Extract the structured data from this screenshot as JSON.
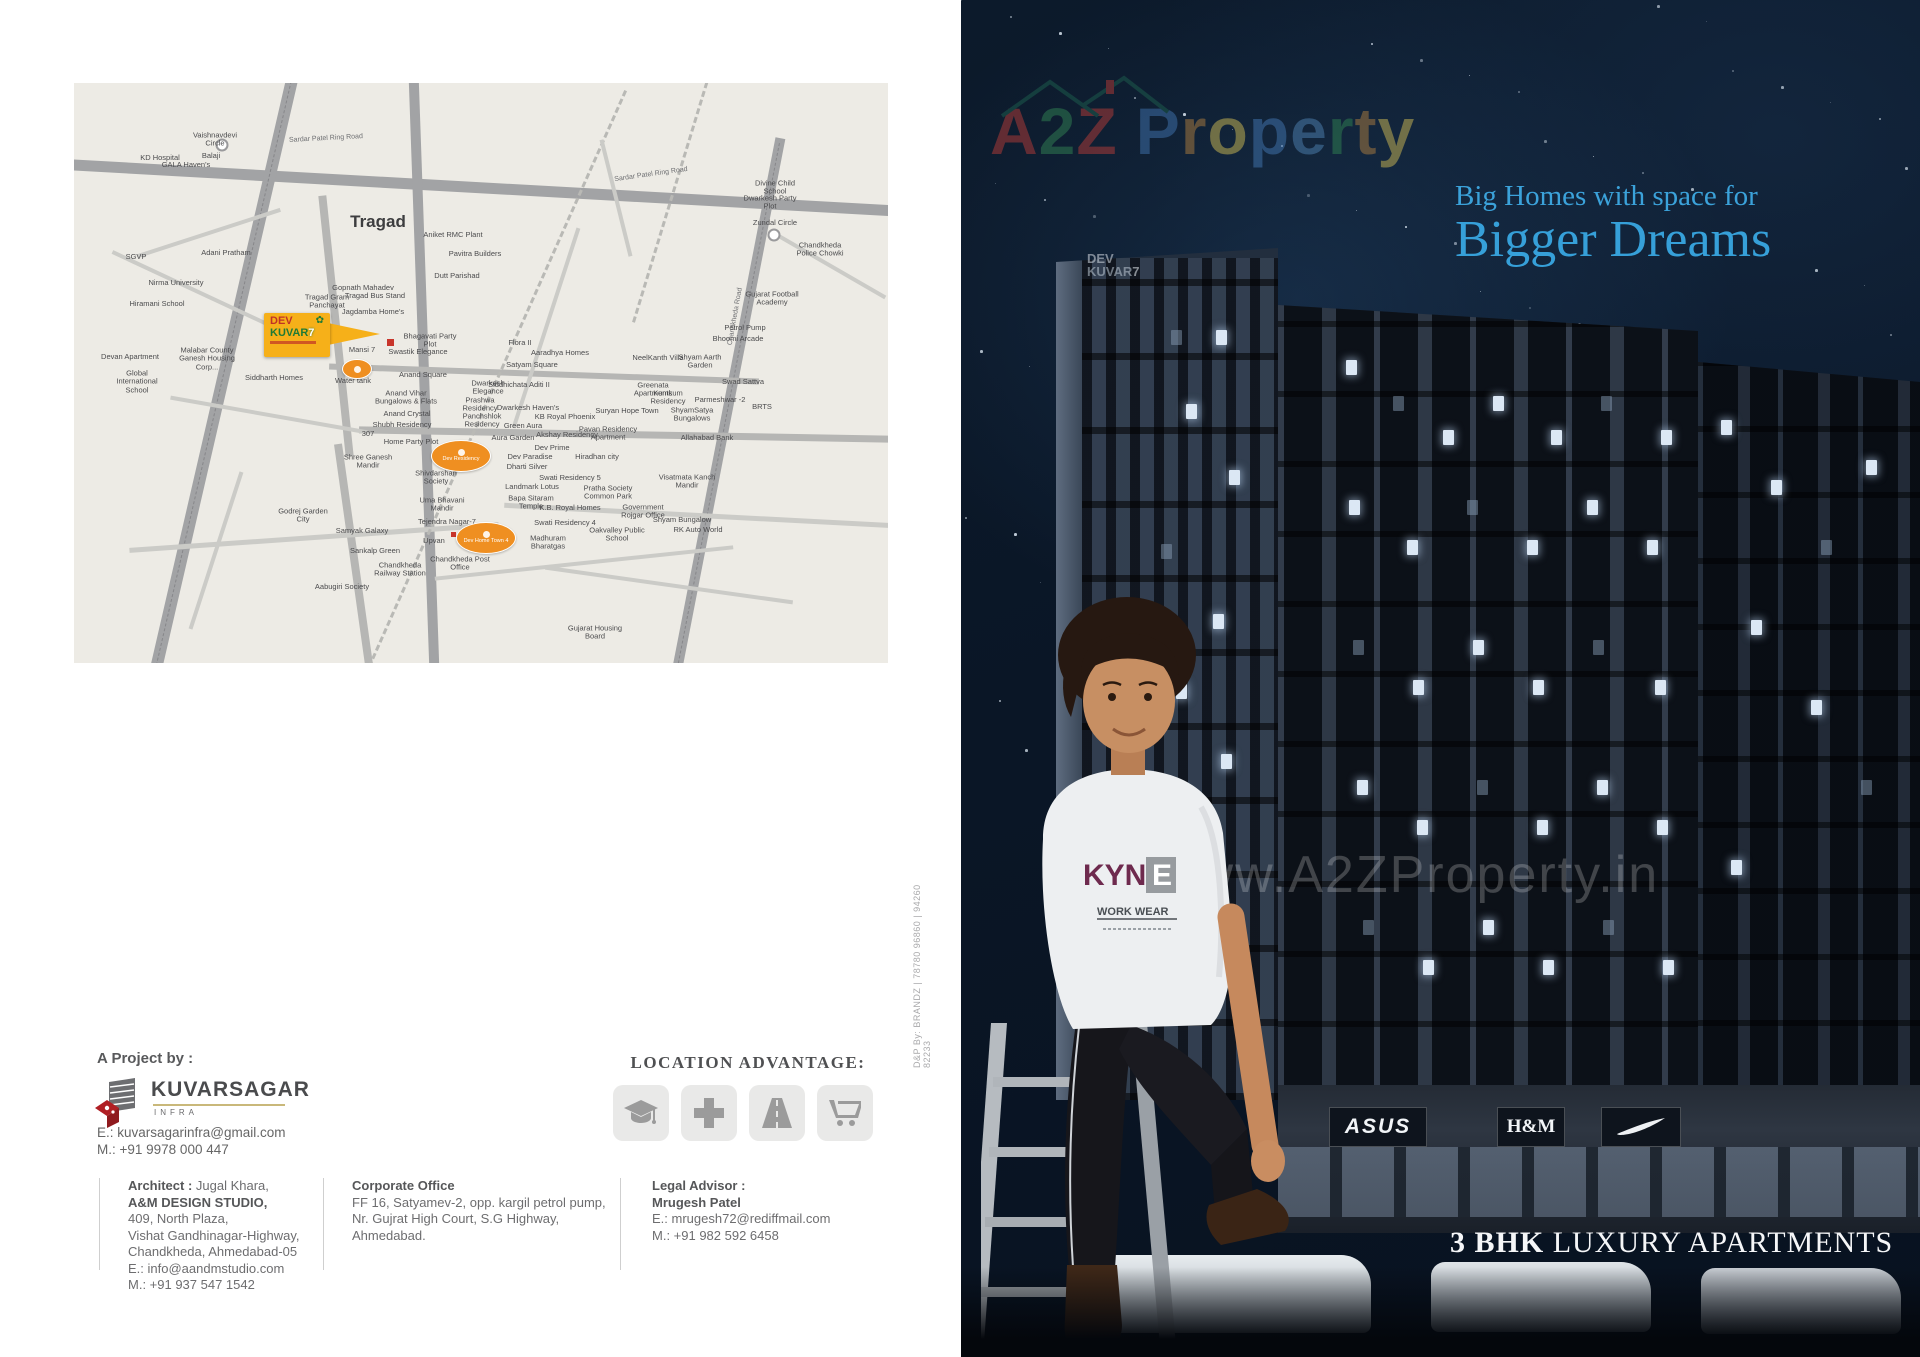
{
  "brochure": {
    "left": {
      "map": {
        "area_label": "Tragad",
        "ring_road_label": "Sardar Patel Ring Road",
        "chandkheda_road_label": "Chandkheda Road",
        "project_box": {
          "line1": "DEV",
          "line2": "KUVAR",
          "seven": "7"
        },
        "badges": [
          {
            "text": "",
            "x": 268,
            "y": 276,
            "w": 28,
            "h": 18
          },
          {
            "text": "Dev Residency",
            "x": 357,
            "y": 357,
            "w": 58,
            "h": 30
          },
          {
            "text": "Dev Home Town 4",
            "x": 382,
            "y": 439,
            "w": 58,
            "h": 30
          }
        ],
        "labels": [
          {
            "t": "Vaishnavdevi Circle",
            "x": 141,
            "y": 57
          },
          {
            "t": "KD Hospital",
            "x": 86,
            "y": 75
          },
          {
            "t": "GALA Haven's",
            "x": 112,
            "y": 82
          },
          {
            "t": "Balaji",
            "x": 137,
            "y": 73
          },
          {
            "t": "SGVP",
            "x": 62,
            "y": 174
          },
          {
            "t": "Nirma University",
            "x": 102,
            "y": 200
          },
          {
            "t": "Hiramani School",
            "x": 83,
            "y": 221
          },
          {
            "t": "Adani Pratham",
            "x": 152,
            "y": 170
          },
          {
            "t": "Malabar County Ganesh Housing Corp...",
            "x": 133,
            "y": 276
          },
          {
            "t": "Siddharth Homes",
            "x": 200,
            "y": 295
          },
          {
            "t": "Devan Apartment",
            "x": 56,
            "y": 274
          },
          {
            "t": "Global International School",
            "x": 63,
            "y": 299
          },
          {
            "t": "Aniket RMC Plant",
            "x": 379,
            "y": 152
          },
          {
            "t": "Pavitra Builders",
            "x": 401,
            "y": 171
          },
          {
            "t": "Dutt Parishad",
            "x": 383,
            "y": 193
          },
          {
            "t": "Gopnath Mahadev",
            "x": 289,
            "y": 205
          },
          {
            "t": "Tragad Bus Stand",
            "x": 301,
            "y": 213
          },
          {
            "t": "Tragad Gram Panchayat",
            "x": 253,
            "y": 219
          },
          {
            "t": "Jagdamba Home's",
            "x": 299,
            "y": 229
          },
          {
            "t": "Bhagavati Party Plot",
            "x": 356,
            "y": 258
          },
          {
            "t": "Swastik Elegance",
            "x": 344,
            "y": 269
          },
          {
            "t": "Mansi 7",
            "x": 288,
            "y": 267
          },
          {
            "t": "Water tank",
            "x": 279,
            "y": 298
          },
          {
            "t": "Anand Square",
            "x": 349,
            "y": 292
          },
          {
            "t": "Anand Vihar Bungalows & Flats",
            "x": 332,
            "y": 315
          },
          {
            "t": "Anand Crystal",
            "x": 333,
            "y": 331
          },
          {
            "t": "Shubh Residency",
            "x": 328,
            "y": 342
          },
          {
            "t": "307",
            "x": 294,
            "y": 351
          },
          {
            "t": "Home Party Plot",
            "x": 337,
            "y": 359
          },
          {
            "t": "Shree Ganesh Mandir",
            "x": 294,
            "y": 379
          },
          {
            "t": "Shivdarshan Society",
            "x": 362,
            "y": 395
          },
          {
            "t": "Uma Bhavani Mandir",
            "x": 368,
            "y": 422
          },
          {
            "t": "Tejendra Nagar-7",
            "x": 373,
            "y": 439
          },
          {
            "t": "Upvan",
            "x": 360,
            "y": 458
          },
          {
            "t": "Sankalp Green",
            "x": 301,
            "y": 468
          },
          {
            "t": "Chandkheda Railway Station",
            "x": 326,
            "y": 487
          },
          {
            "t": "Chandkheda Post Office",
            "x": 386,
            "y": 481
          },
          {
            "t": "Samyak Galaxy",
            "x": 288,
            "y": 448
          },
          {
            "t": "Godrej Garden City",
            "x": 229,
            "y": 433
          },
          {
            "t": "Aabugiri Society",
            "x": 268,
            "y": 504
          },
          {
            "t": "Dwarkesh Elegance",
            "x": 414,
            "y": 305
          },
          {
            "t": "Prashwa Residency",
            "x": 406,
            "y": 322
          },
          {
            "t": "Panchshlok Residency",
            "x": 408,
            "y": 338
          },
          {
            "t": "Siddhichata Aditi II",
            "x": 445,
            "y": 302
          },
          {
            "t": "Dwarkesh Haven's",
            "x": 454,
            "y": 325
          },
          {
            "t": "Green Aura",
            "x": 449,
            "y": 343
          },
          {
            "t": "Aura Garden",
            "x": 439,
            "y": 355
          },
          {
            "t": "Satyam Square",
            "x": 458,
            "y": 282
          },
          {
            "t": "Flora II",
            "x": 446,
            "y": 260
          },
          {
            "t": "Aaradhya Homes",
            "x": 486,
            "y": 270
          },
          {
            "t": "NeelKanth Villa",
            "x": 584,
            "y": 275
          },
          {
            "t": "Shyam Aarth Garden",
            "x": 626,
            "y": 279
          },
          {
            "t": "Greenata Apartments",
            "x": 579,
            "y": 307
          },
          {
            "t": "Kumkum Residency",
            "x": 594,
            "y": 315
          },
          {
            "t": "Suryan Hope Town",
            "x": 553,
            "y": 328
          },
          {
            "t": "ShyamSatya Bungalows",
            "x": 618,
            "y": 332
          },
          {
            "t": "KB Royal Phoenix",
            "x": 491,
            "y": 334
          },
          {
            "t": "Akshay Residency",
            "x": 493,
            "y": 352
          },
          {
            "t": "Pavan Residency Apartment",
            "x": 534,
            "y": 351
          },
          {
            "t": "Hiradhan city",
            "x": 523,
            "y": 374
          },
          {
            "t": "Allahabad Bank",
            "x": 633,
            "y": 355
          },
          {
            "t": "Visatmata Kanch Mandir",
            "x": 613,
            "y": 399
          },
          {
            "t": "Pratha Society Common Park",
            "x": 534,
            "y": 410
          },
          {
            "t": "Government Rojgar Office",
            "x": 569,
            "y": 429
          },
          {
            "t": "Shyam Bungalow",
            "x": 608,
            "y": 437
          },
          {
            "t": "RK Auto World",
            "x": 624,
            "y": 447
          },
          {
            "t": "Oakvalley Public School",
            "x": 543,
            "y": 452
          },
          {
            "t": "Swati Residency 5",
            "x": 496,
            "y": 395
          },
          {
            "t": "Landmark Lotus",
            "x": 458,
            "y": 404
          },
          {
            "t": "Bapa Sitaram Temple",
            "x": 457,
            "y": 420
          },
          {
            "t": "K.B. Royal Homes",
            "x": 496,
            "y": 425
          },
          {
            "t": "Swati Residency 4",
            "x": 491,
            "y": 440
          },
          {
            "t": "Madhuram Bharatgas",
            "x": 474,
            "y": 460
          },
          {
            "t": "Dev Prime",
            "x": 478,
            "y": 365
          },
          {
            "t": "Dev Paradise",
            "x": 456,
            "y": 374
          },
          {
            "t": "Dharti Silver",
            "x": 453,
            "y": 384
          },
          {
            "t": "Gujarat Housing Board",
            "x": 521,
            "y": 550
          },
          {
            "t": "Divine Child School",
            "x": 701,
            "y": 105
          },
          {
            "t": "Dwarkesh Party Plot",
            "x": 696,
            "y": 120
          },
          {
            "t": "Zundal Circle",
            "x": 701,
            "y": 140
          },
          {
            "t": "Chandkheda Police Chowki",
            "x": 746,
            "y": 167
          },
          {
            "t": "Gujarat Football Academy",
            "x": 698,
            "y": 216
          },
          {
            "t": "Petrol Pump",
            "x": 671,
            "y": 245
          },
          {
            "t": "Bhoomi Arcade",
            "x": 664,
            "y": 256
          },
          {
            "t": "Swad Sattva",
            "x": 669,
            "y": 299
          },
          {
            "t": "Parmeshwar -2",
            "x": 646,
            "y": 317
          },
          {
            "t": "BRTS",
            "x": 688,
            "y": 324
          }
        ]
      },
      "project": {
        "heading": "A Project by :",
        "brand": "KUVARSAGAR",
        "brand_sub": "INFRA",
        "email": "E.: kuvarsagarinfra@gmail.com",
        "phone": "M.: +91 9978 000 447"
      },
      "architect": {
        "label": "Architect :",
        "name": " Jugal Khara,",
        "studio": "A&M DESIGN STUDIO,",
        "lines": [
          "409, North Plaza,",
          "Vishat Gandhinagar-Highway,",
          "Chandkheda, Ahmedabad-05",
          "E.: info@aandmstudio.com",
          "M.: +91 937 547 1542"
        ]
      },
      "corporate": {
        "title": "Corporate Office",
        "lines": [
          "FF 16, Satyamev-2, opp. kargil petrol pump,",
          "Nr. Gujrat High Court, S.G Highway,",
          "Ahmedabad."
        ]
      },
      "legal": {
        "title": "Legal Advisor :",
        "name": "Mrugesh Patel",
        "lines": [
          "E.: mrugesh72@rediffmail.com",
          "M.: +91 982 592 6458"
        ]
      },
      "location_advantage": {
        "title": "LOCATION ADVANTAGE:",
        "icons": [
          "education",
          "hospital",
          "highway",
          "shopping"
        ]
      },
      "credit": "D&P By: BRANDZ | 78780 96860 | 94260 82233"
    },
    "right": {
      "brand_logo": {
        "part1": "A2Z",
        "part2": "Property"
      },
      "tagline1": "Big Homes with space for",
      "tagline2": "Bigger Dreams",
      "tower_logo": {
        "line1": "DEV",
        "line2": "KUVAR",
        "seven": "7"
      },
      "watermark": "www.A2ZProperty.in",
      "tshirt": {
        "brand": "KYNE",
        "sub": "WORK WEAR"
      },
      "shops": [
        "ASUS",
        "H&M",
        "NIKE"
      ],
      "footer_bold": "3 BHK",
      "footer_rest": " LUXURY APARTMENTS"
    }
  }
}
